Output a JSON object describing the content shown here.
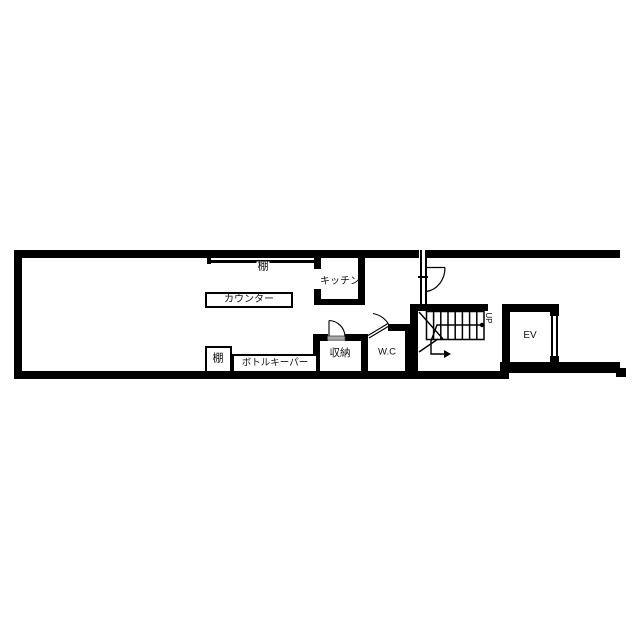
{
  "plan_title": "floor-plan",
  "colors": {
    "wall": "#000000",
    "background": "#ffffff",
    "text": "#111111",
    "door_threshold": "#a8a8a8"
  },
  "rooms": {
    "kitchen": {
      "label": "キッチン"
    },
    "storage": {
      "label": "収納"
    },
    "toilet": {
      "label": "W.C"
    },
    "elevator": {
      "label": "EV"
    }
  },
  "fixtures": {
    "top_shelf": {
      "label": "棚"
    },
    "counter": {
      "label": "カウンター"
    },
    "bottom_shelf": {
      "label": "棚"
    },
    "bottle_keeper": {
      "label": "ボトルキーパー"
    }
  },
  "stairs": {
    "direction_label": "UP"
  }
}
